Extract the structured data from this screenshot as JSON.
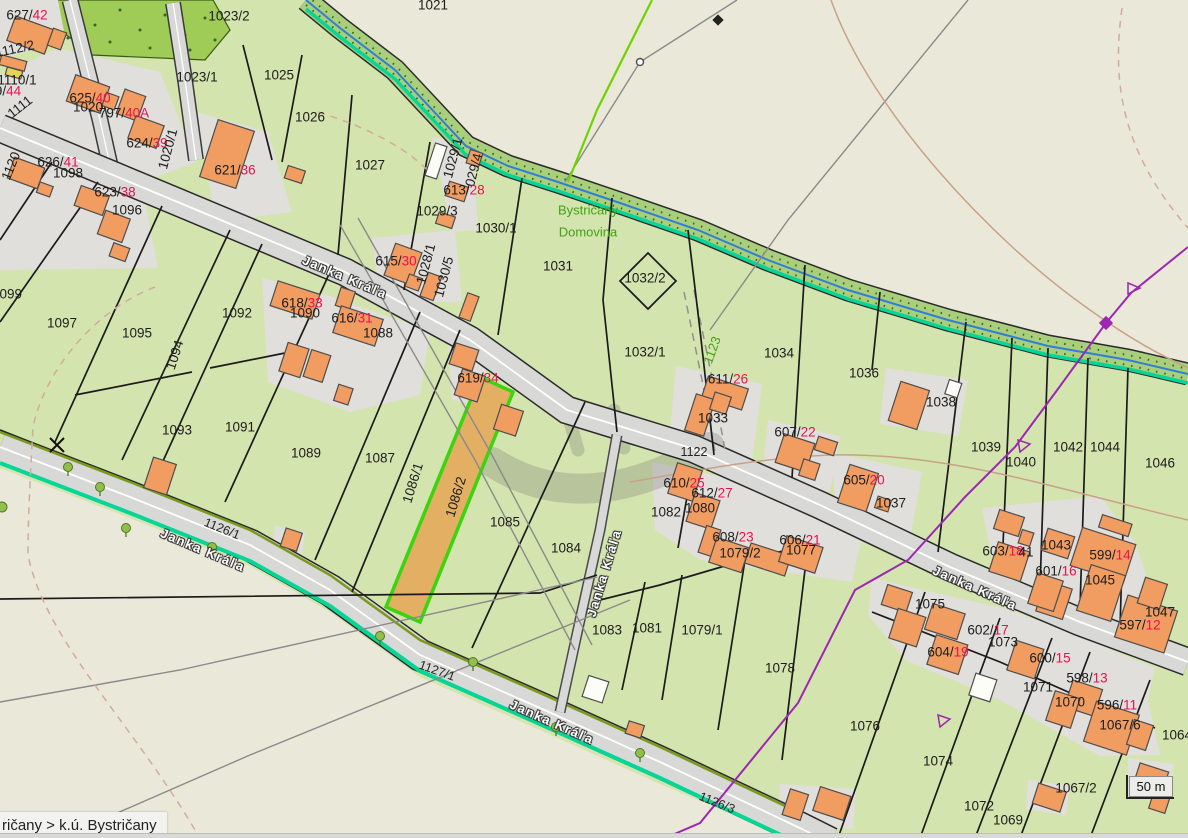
{
  "app": {
    "type": "cadastral-map-viewer",
    "region": "k.ú. Bystričany"
  },
  "breadcrumb": {
    "text": "ričany > k.ú. Bystričany"
  },
  "scale_bar": {
    "label": "50 m"
  },
  "colors": {
    "background_beige": "#eae8d8",
    "parcel_green": "#d3e4ae",
    "yard_gray": "#e0dfdb",
    "building_orange": "#f19c60",
    "road_gray": "#d8d8d6",
    "stream_teal": "#06d598",
    "stream_blue": "#2f7fd6",
    "forest_green": "#9fcb57",
    "highlight_fill": "#e3b063",
    "highlight_border": "#3bd40f",
    "label_black": "#1c1c1c",
    "label_red": "#ee1050",
    "label_green": "#3fa313",
    "powerline_purple": "#9c27b0"
  },
  "map": {
    "highlighted_parcel": {
      "id": "1086/2"
    },
    "street_name": "Janka Kráľa",
    "place_names": [
      "Bystričany",
      "Domovina"
    ],
    "labels": [
      {
        "x": 27,
        "y": 15,
        "black": "627/",
        "red": "42"
      },
      {
        "x": 433,
        "y": 5,
        "black": "1021"
      },
      {
        "x": 229,
        "y": 16,
        "black": "1023/2"
      },
      {
        "x": 15,
        "y": 49,
        "black": "1112/2",
        "rot": -12
      },
      {
        "x": 197,
        "y": 77,
        "black": "1023/1"
      },
      {
        "x": 279,
        "y": 75,
        "black": "1025"
      },
      {
        "x": 17,
        "y": 80,
        "black": "1110/1"
      },
      {
        "x": 8,
        "y": 91,
        "black": "9/",
        "red": "44"
      },
      {
        "x": 20,
        "y": 107,
        "black": "1111",
        "rot": -38
      },
      {
        "x": 90,
        "y": 98,
        "black": "625/",
        "red": "40"
      },
      {
        "x": 88,
        "y": 107,
        "black": "1020"
      },
      {
        "x": 124,
        "y": 113,
        "black": "797/",
        "red": "40A"
      },
      {
        "x": 310,
        "y": 117,
        "black": "1026"
      },
      {
        "x": 147,
        "y": 143,
        "black": "624/",
        "red": "39"
      },
      {
        "x": 168,
        "y": 149,
        "black": "1020/1",
        "rot": -75
      },
      {
        "x": 11,
        "y": 166,
        "black": "1120",
        "rot": -68
      },
      {
        "x": 58,
        "y": 162,
        "black": "626/",
        "red": "41"
      },
      {
        "x": 68,
        "y": 173,
        "black": "1098"
      },
      {
        "x": 235,
        "y": 170,
        "black": "621/",
        "red": "36"
      },
      {
        "x": 370,
        "y": 165,
        "black": "1027"
      },
      {
        "x": 115,
        "y": 192,
        "black": "623/",
        "red": "38"
      },
      {
        "x": 127,
        "y": 210,
        "black": "1096"
      },
      {
        "x": 453,
        "y": 158,
        "black": "1029/1",
        "rot": -75
      },
      {
        "x": 474,
        "y": 170,
        "black": "029/4",
        "rot": -75
      },
      {
        "x": 464,
        "y": 190,
        "black": "613/",
        "red": "28"
      },
      {
        "x": 437,
        "y": 211,
        "black": "1029/3"
      },
      {
        "x": 496,
        "y": 228,
        "black": "1030/1"
      },
      {
        "x": 396,
        "y": 261,
        "black": "615/",
        "red": "30"
      },
      {
        "x": 426,
        "y": 264,
        "black": "1028/1",
        "rot": -75
      },
      {
        "x": 444,
        "y": 277,
        "black": "1030/5",
        "rot": -75
      },
      {
        "x": 558,
        "y": 266,
        "black": "1031"
      },
      {
        "x": 645,
        "y": 278,
        "black": "1032/2"
      },
      {
        "x": 588,
        "y": 210,
        "black": "Bystričany",
        "style": "green"
      },
      {
        "x": 588,
        "y": 232,
        "black": "Domovina",
        "style": "green"
      },
      {
        "x": 712,
        "y": 350,
        "black": "1123",
        "style": "green",
        "rot": -70
      },
      {
        "x": 7,
        "y": 294,
        "black": "1099"
      },
      {
        "x": 62,
        "y": 323,
        "black": "1097"
      },
      {
        "x": 137,
        "y": 333,
        "black": "1095"
      },
      {
        "x": 175,
        "y": 355,
        "black": "1094",
        "rot": -72
      },
      {
        "x": 237,
        "y": 313,
        "black": "1092"
      },
      {
        "x": 302,
        "y": 303,
        "black": "618/",
        "red": "33"
      },
      {
        "x": 305,
        "y": 313,
        "black": "1090"
      },
      {
        "x": 352,
        "y": 318,
        "black": "616/",
        "red": "31"
      },
      {
        "x": 378,
        "y": 333,
        "black": "1088"
      },
      {
        "x": 177,
        "y": 430,
        "black": "1093"
      },
      {
        "x": 240,
        "y": 427,
        "black": "1091"
      },
      {
        "x": 306,
        "y": 453,
        "black": "1089"
      },
      {
        "x": 380,
        "y": 458,
        "black": "1087"
      },
      {
        "x": 478,
        "y": 378,
        "black": "619/",
        "red": "34"
      },
      {
        "x": 413,
        "y": 483,
        "black": "1086/1",
        "rot": -73
      },
      {
        "x": 456,
        "y": 497,
        "black": "1086/2",
        "rot": -73
      },
      {
        "x": 505,
        "y": 522,
        "black": "1085"
      },
      {
        "x": 566,
        "y": 548,
        "black": "1084"
      },
      {
        "x": 645,
        "y": 352,
        "black": "1032/1"
      },
      {
        "x": 779,
        "y": 353,
        "black": "1034"
      },
      {
        "x": 864,
        "y": 373,
        "black": "1036"
      },
      {
        "x": 728,
        "y": 379,
        "black": "611/",
        "red": "26"
      },
      {
        "x": 713,
        "y": 418,
        "black": "1033"
      },
      {
        "x": 941,
        "y": 402,
        "black": "1038"
      },
      {
        "x": 795,
        "y": 432,
        "black": "607/",
        "red": "22"
      },
      {
        "x": 694,
        "y": 452,
        "black": "1122",
        "style": "road"
      },
      {
        "x": 684,
        "y": 483,
        "black": "610/",
        "red": "25"
      },
      {
        "x": 712,
        "y": 493,
        "black": "612/",
        "red": "27"
      },
      {
        "x": 864,
        "y": 480,
        "black": "605/",
        "red": "20"
      },
      {
        "x": 891,
        "y": 503,
        "black": "1037"
      },
      {
        "x": 700,
        "y": 508,
        "black": "1080"
      },
      {
        "x": 666,
        "y": 512,
        "black": "1082"
      },
      {
        "x": 733,
        "y": 537,
        "black": "608/",
        "red": "23"
      },
      {
        "x": 740,
        "y": 553,
        "black": "1079/2"
      },
      {
        "x": 800,
        "y": 540,
        "black": "606/",
        "red": "21"
      },
      {
        "x": 801,
        "y": 550,
        "black": "1077"
      },
      {
        "x": 986,
        "y": 447,
        "black": "1039"
      },
      {
        "x": 1021,
        "y": 462,
        "black": "1040"
      },
      {
        "x": 1068,
        "y": 447,
        "black": "1042"
      },
      {
        "x": 1105,
        "y": 447,
        "black": "1044"
      },
      {
        "x": 1160,
        "y": 463,
        "black": "1046"
      },
      {
        "x": 1056,
        "y": 545,
        "black": "1043"
      },
      {
        "x": 1003,
        "y": 551,
        "black": "603/",
        "red": "18"
      },
      {
        "x": 1026,
        "y": 552,
        "black": "41"
      },
      {
        "x": 1110,
        "y": 555,
        "black": "599/",
        "red": "14"
      },
      {
        "x": 1056,
        "y": 571,
        "black": "601/",
        "red": "16"
      },
      {
        "x": 1100,
        "y": 580,
        "black": "1045"
      },
      {
        "x": 1160,
        "y": 612,
        "black": "1047"
      },
      {
        "x": 1140,
        "y": 625,
        "black": "597/",
        "red": "12"
      },
      {
        "x": 222,
        "y": 529,
        "black": "1126/1",
        "rot": 22,
        "style": "road"
      },
      {
        "x": 437,
        "y": 671,
        "black": "1127/1",
        "rot": 20,
        "style": "road"
      },
      {
        "x": 717,
        "y": 803,
        "black": "1126/3",
        "rot": 22,
        "style": "road"
      },
      {
        "x": 607,
        "y": 630,
        "black": "1083"
      },
      {
        "x": 647,
        "y": 628,
        "black": "1081"
      },
      {
        "x": 702,
        "y": 630,
        "black": "1079/1"
      },
      {
        "x": 780,
        "y": 668,
        "black": "1078"
      },
      {
        "x": 865,
        "y": 726,
        "black": "1076"
      },
      {
        "x": 930,
        "y": 604,
        "black": "1075"
      },
      {
        "x": 988,
        "y": 630,
        "black": "602/",
        "red": "17"
      },
      {
        "x": 1003,
        "y": 642,
        "black": "1073"
      },
      {
        "x": 948,
        "y": 652,
        "black": "604/",
        "red": "19"
      },
      {
        "x": 1050,
        "y": 658,
        "black": "600/",
        "red": "15"
      },
      {
        "x": 1038,
        "y": 687,
        "black": "1071"
      },
      {
        "x": 1087,
        "y": 678,
        "black": "598/",
        "red": "13"
      },
      {
        "x": 1070,
        "y": 702,
        "black": "1070"
      },
      {
        "x": 1117,
        "y": 705,
        "black": "596/",
        "red": "11"
      },
      {
        "x": 1120,
        "y": 725,
        "black": "1067/6"
      },
      {
        "x": 1177,
        "y": 735,
        "black": "1064"
      },
      {
        "x": 938,
        "y": 761,
        "black": "1074"
      },
      {
        "x": 979,
        "y": 806,
        "black": "1072"
      },
      {
        "x": 1008,
        "y": 820,
        "black": "1069"
      },
      {
        "x": 1076,
        "y": 788,
        "black": "1067/2"
      },
      {
        "x": 345,
        "y": 277,
        "black": "Janka Kráľa",
        "rot": 23,
        "style": "street"
      },
      {
        "x": 975,
        "y": 588,
        "black": "Janka Kráľa",
        "rot": 24,
        "style": "street"
      },
      {
        "x": 203,
        "y": 550,
        "black": "Janka Kráľa",
        "rot": 23,
        "style": "street"
      },
      {
        "x": 552,
        "y": 722,
        "black": "Janka Kráľa",
        "rot": 24,
        "style": "street"
      },
      {
        "x": 604,
        "y": 573,
        "black": "Janka Kráľa",
        "rot": -73,
        "style": "street"
      }
    ]
  }
}
